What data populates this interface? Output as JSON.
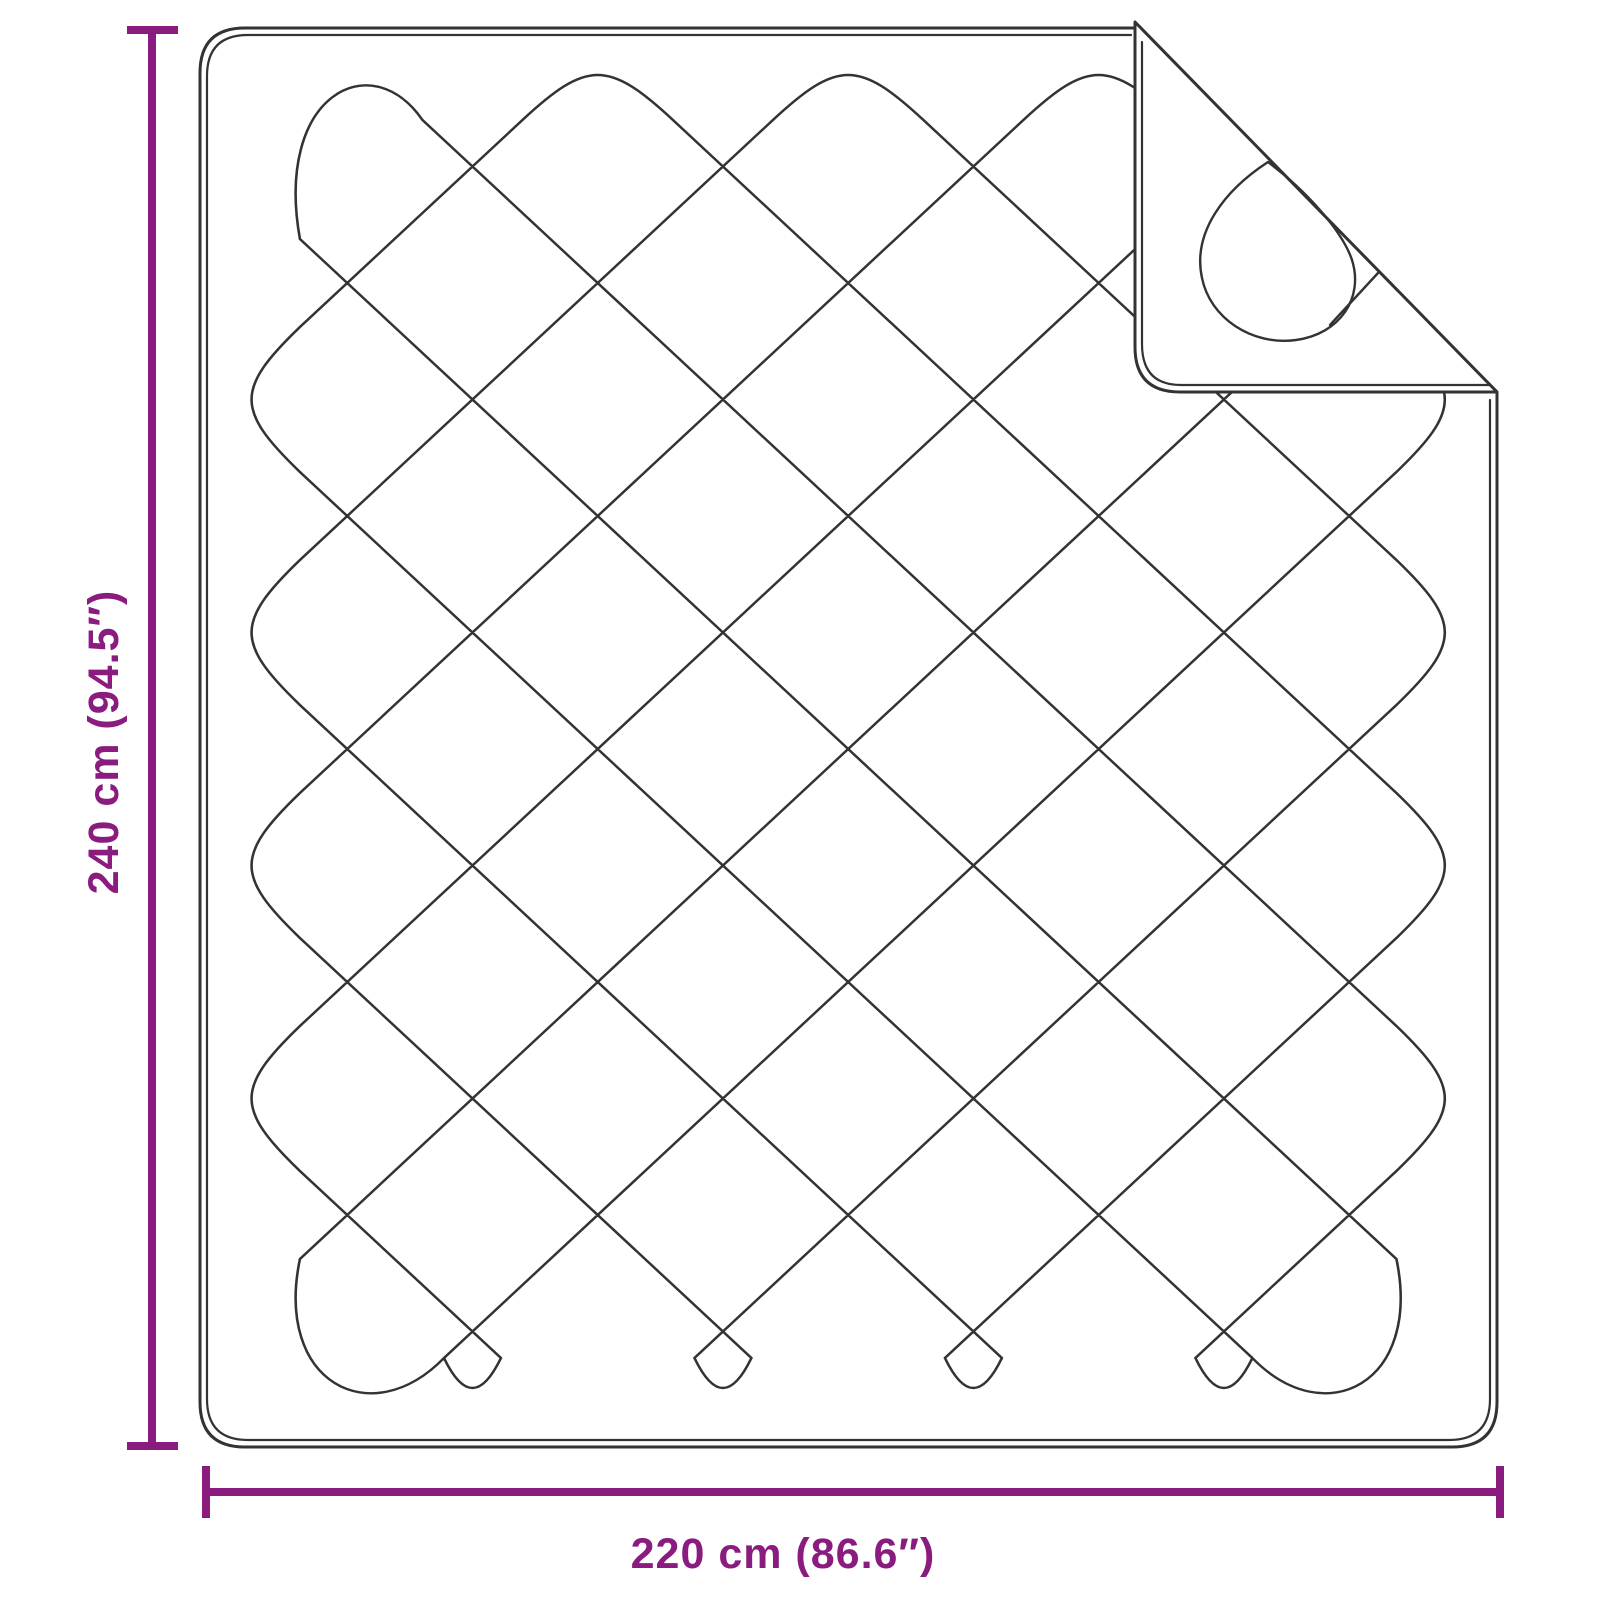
{
  "diagram": {
    "title": "Quilted blanket dimension diagram",
    "height_label": "240 cm (94.5″)",
    "width_label": "220 cm (86.6″)"
  },
  "colors": {
    "dimension": "#8A1B7F",
    "line": "#333333",
    "background": "#ffffff"
  }
}
